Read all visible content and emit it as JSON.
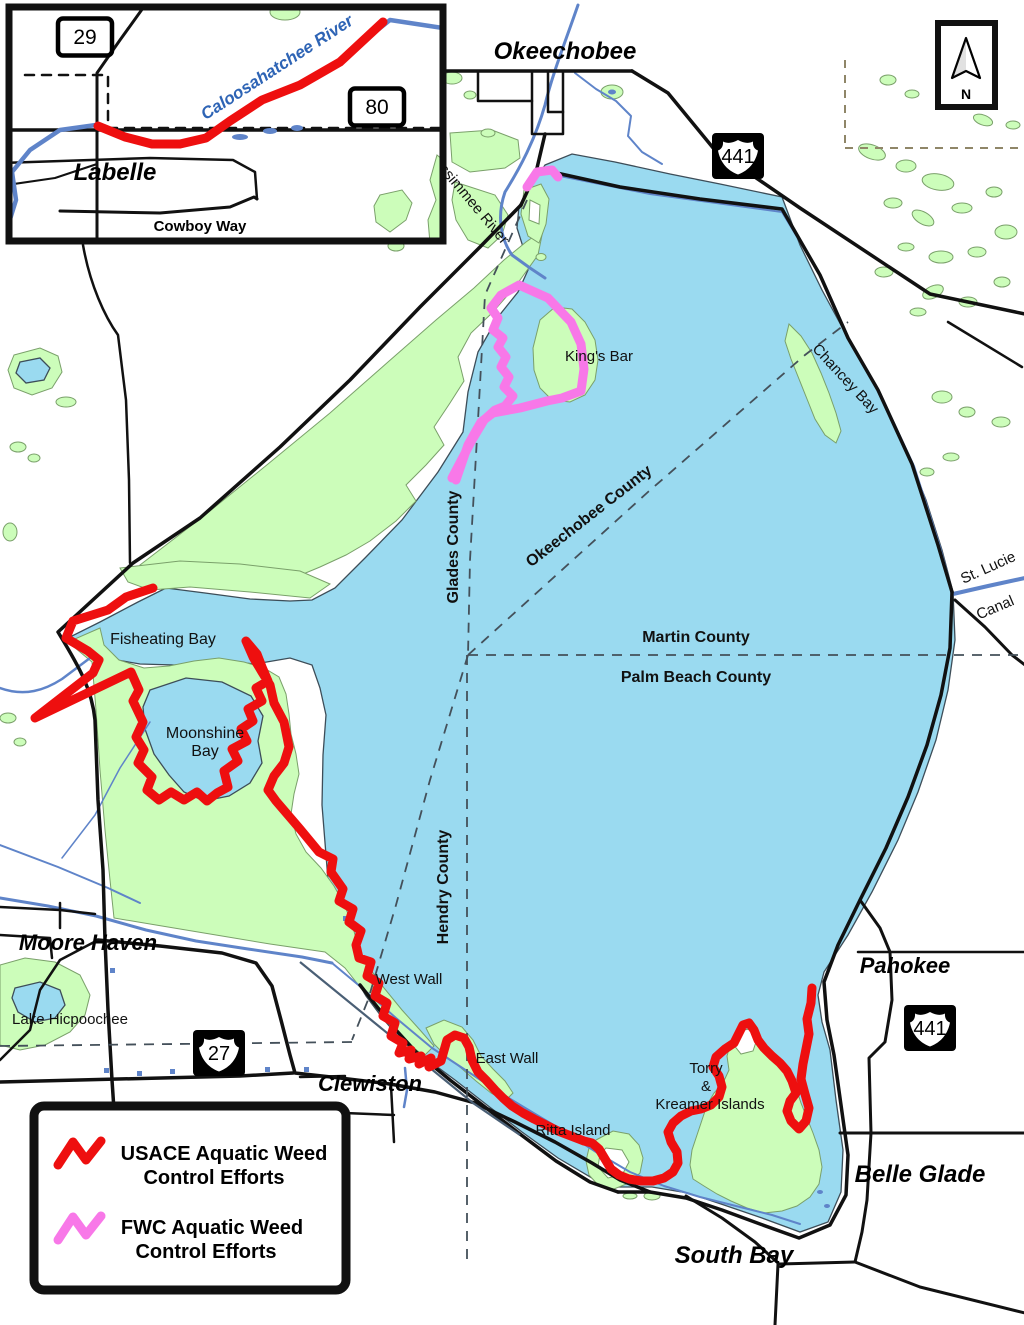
{
  "colors": {
    "lake": "#9ADAF0",
    "marsh": "#CCFDBA",
    "river_blue": "#5F84C9",
    "usace_red": "#EE0F0F",
    "fwc_pink": "#F878E8"
  },
  "labels": {
    "okeechobee": "Okeechobee",
    "moore_haven": "Moore Haven",
    "clewiston": "Clewiston",
    "pahokee": "Pahokee",
    "belle_glade": "Belle Glade",
    "south_bay": "South Bay",
    "labelle": "Labelle",
    "kings_bar": "King's Bar",
    "fisheating_bay": "Fisheating Bay",
    "moonshine": "Moonshine",
    "bay": "Bay",
    "west_wall": "West Wall",
    "east_wall": "East Wall",
    "ritta_island": "Ritta Island",
    "torry": "Torry",
    "amp": "&",
    "kreamer_islands": "Kreamer Islands",
    "lake_hicpoochee": "Lake Hicpoochee",
    "chancey_bay": "Chancey Bay",
    "kissimmee_river": "Kissimmee River",
    "caloosahatchee_river": "Caloosahatchee River",
    "st_lucie": "St. Lucie",
    "canal": "Canal",
    "cowboy_way": "Cowboy Way",
    "glades_county": "Glades County",
    "okeechobee_county": "Okeechobee County",
    "martin_county": "Martin County",
    "palm_beach_county": "Palm Beach County",
    "hendry_county": "Hendry County",
    "north": "N"
  },
  "shields": {
    "sr29": "29",
    "sr80": "80",
    "us441": "441",
    "us27": "27"
  },
  "legend": {
    "usace_line1": "USACE Aquatic Weed",
    "usace_line2": "Control Efforts",
    "fwc_line1": "FWC Aquatic Weed",
    "fwc_line2": "Control Efforts"
  }
}
